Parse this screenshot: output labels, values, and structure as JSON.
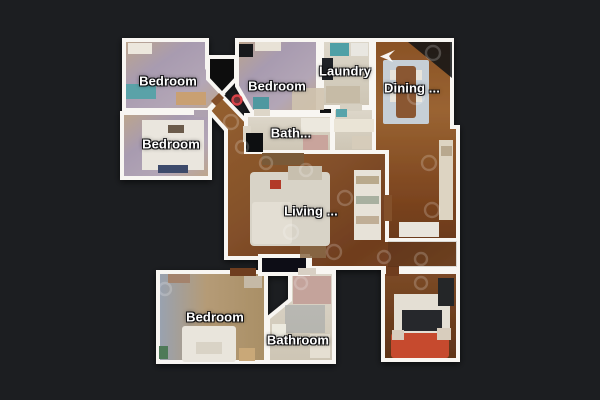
{
  "scene": {
    "view": "floorplan",
    "background_color": "#1c1e21",
    "wall_color": "#f8f6f2"
  },
  "rooms": [
    {
      "id": "bedroom-top-left",
      "label": "Bedroom"
    },
    {
      "id": "bedroom-mid-left",
      "label": "Bedroom"
    },
    {
      "id": "bedroom-top-middle",
      "label": "Bedroom"
    },
    {
      "id": "laundry",
      "label": "Laundry"
    },
    {
      "id": "dining",
      "label": "Dining ..."
    },
    {
      "id": "bath",
      "label": "Bath..."
    },
    {
      "id": "living",
      "label": "Living ..."
    },
    {
      "id": "bedroom-bottom-left",
      "label": "Bedroom"
    },
    {
      "id": "bathroom",
      "label": "Bathroom"
    }
  ],
  "markers": {
    "position_marker_color": "#d84248",
    "view_arrow_color": "#ffffff"
  }
}
